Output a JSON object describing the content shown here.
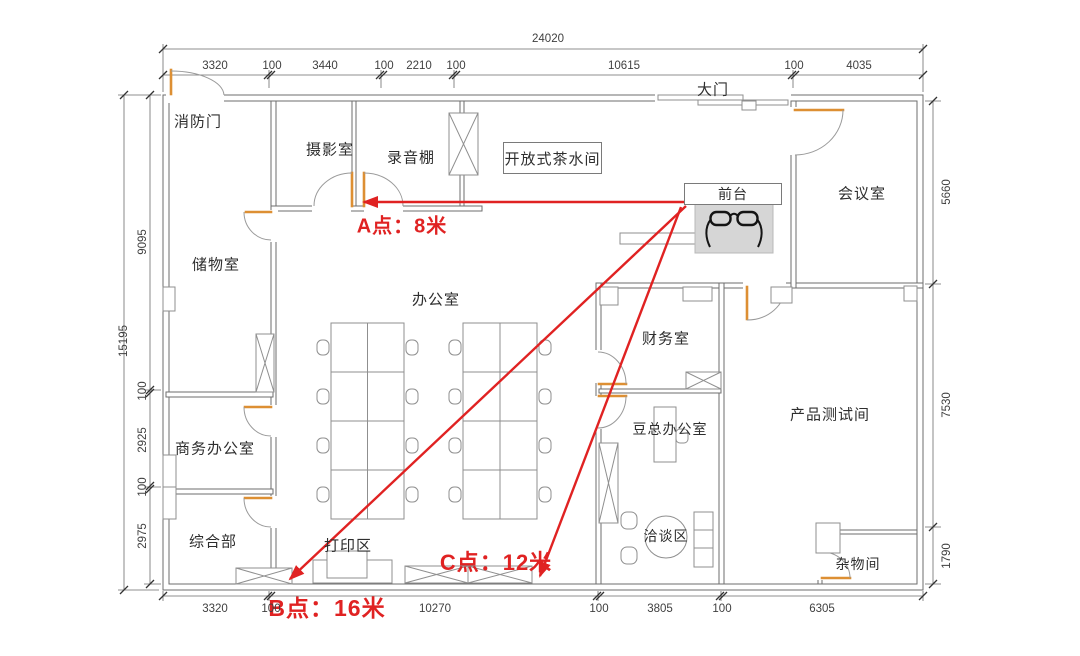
{
  "rooms": {
    "fire_door": "消防门",
    "photo_room": "摄影室",
    "recording_studio": "录音棚",
    "open_pantry": "开放式茶水间",
    "main_gate": "大门",
    "reception": "前台",
    "meeting_room": "会议室",
    "storage_room": "储物室",
    "office": "办公室",
    "finance_room": "财务室",
    "business_office": "商务办公室",
    "dou_office": "豆总办公室",
    "general_dept": "综合部",
    "print_area": "打印区",
    "negotiation_area": "洽谈区",
    "sundry_room": "杂物间",
    "product_test_room": "产品测试间"
  },
  "annotations": {
    "point_a": "A点：8米",
    "point_b": "B点：16米",
    "point_c": "C点：12米"
  },
  "dimensions": {
    "top_total": "24020",
    "top": [
      "3320",
      "100",
      "3440",
      "100",
      "2210",
      "100",
      "10615",
      "100",
      "4035"
    ],
    "bottom": [
      "3320",
      "100",
      "10270",
      "100",
      "3805",
      "100",
      "6305"
    ],
    "left_total": "15195",
    "left": [
      "9095",
      "100",
      "2925",
      "100",
      "2975"
    ],
    "right": [
      "5660",
      "7530",
      "1790"
    ]
  },
  "colors": {
    "wall": "#6e6e6e",
    "door": "#dd8f33",
    "annotation": "#e02222",
    "dim_text": "#3f3f3f"
  }
}
